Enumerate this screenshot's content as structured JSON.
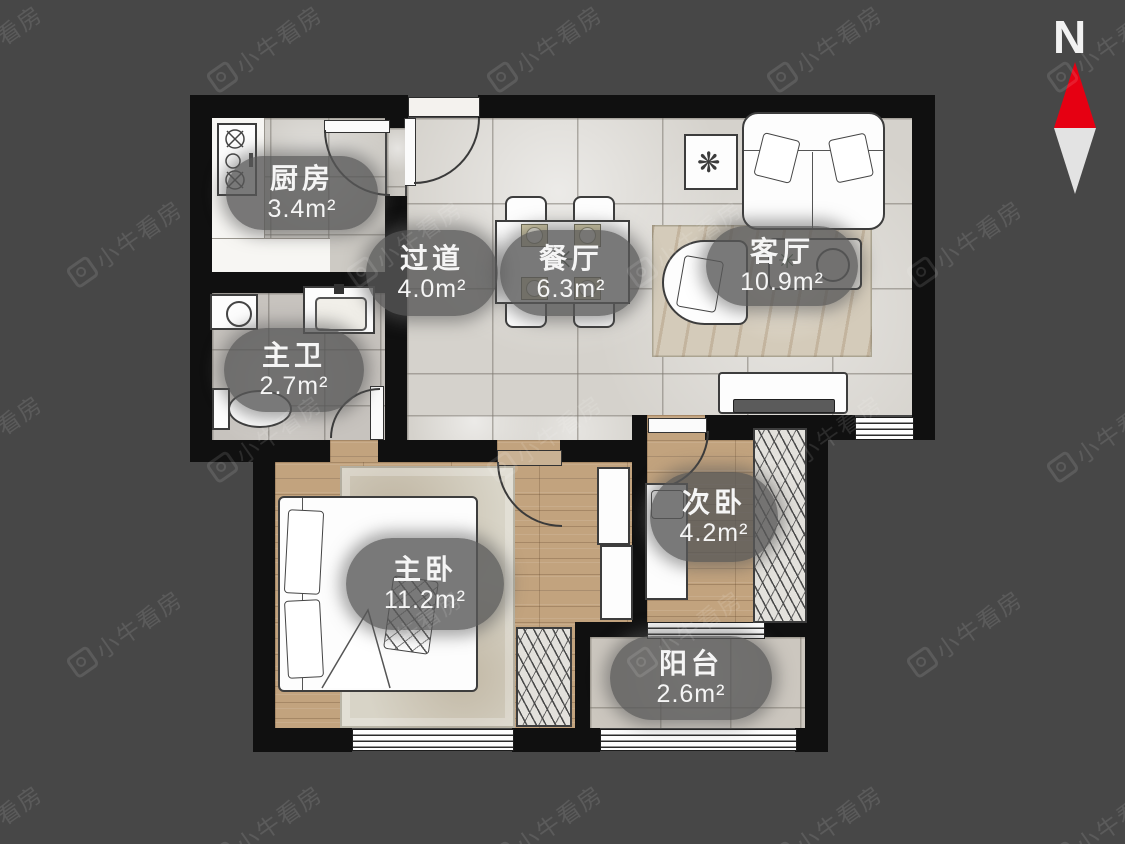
{
  "meta": {
    "compass_label": "N",
    "watermark_text": "小牛看房"
  },
  "rooms": {
    "kitchen": {
      "name": "厨房",
      "area": "3.4m²"
    },
    "hallway": {
      "name": "过道",
      "area": "4.0m²"
    },
    "dining": {
      "name": "餐厅",
      "area": "6.3m²"
    },
    "living": {
      "name": "客厅",
      "area": "10.9m²"
    },
    "master_bath": {
      "name": "主卫",
      "area": "2.7m²"
    },
    "master_bedroom": {
      "name": "主卧",
      "area": "11.2m²"
    },
    "second_bedroom": {
      "name": "次卧",
      "area": "4.2m²"
    },
    "balcony": {
      "name": "阳台",
      "area": "2.6m²"
    }
  },
  "colors": {
    "background": "#474747",
    "wall": "#101010",
    "north_red": "#e60012",
    "label_text": "#f5f5f5",
    "label_pill": "rgba(88,88,88,0.8)"
  }
}
